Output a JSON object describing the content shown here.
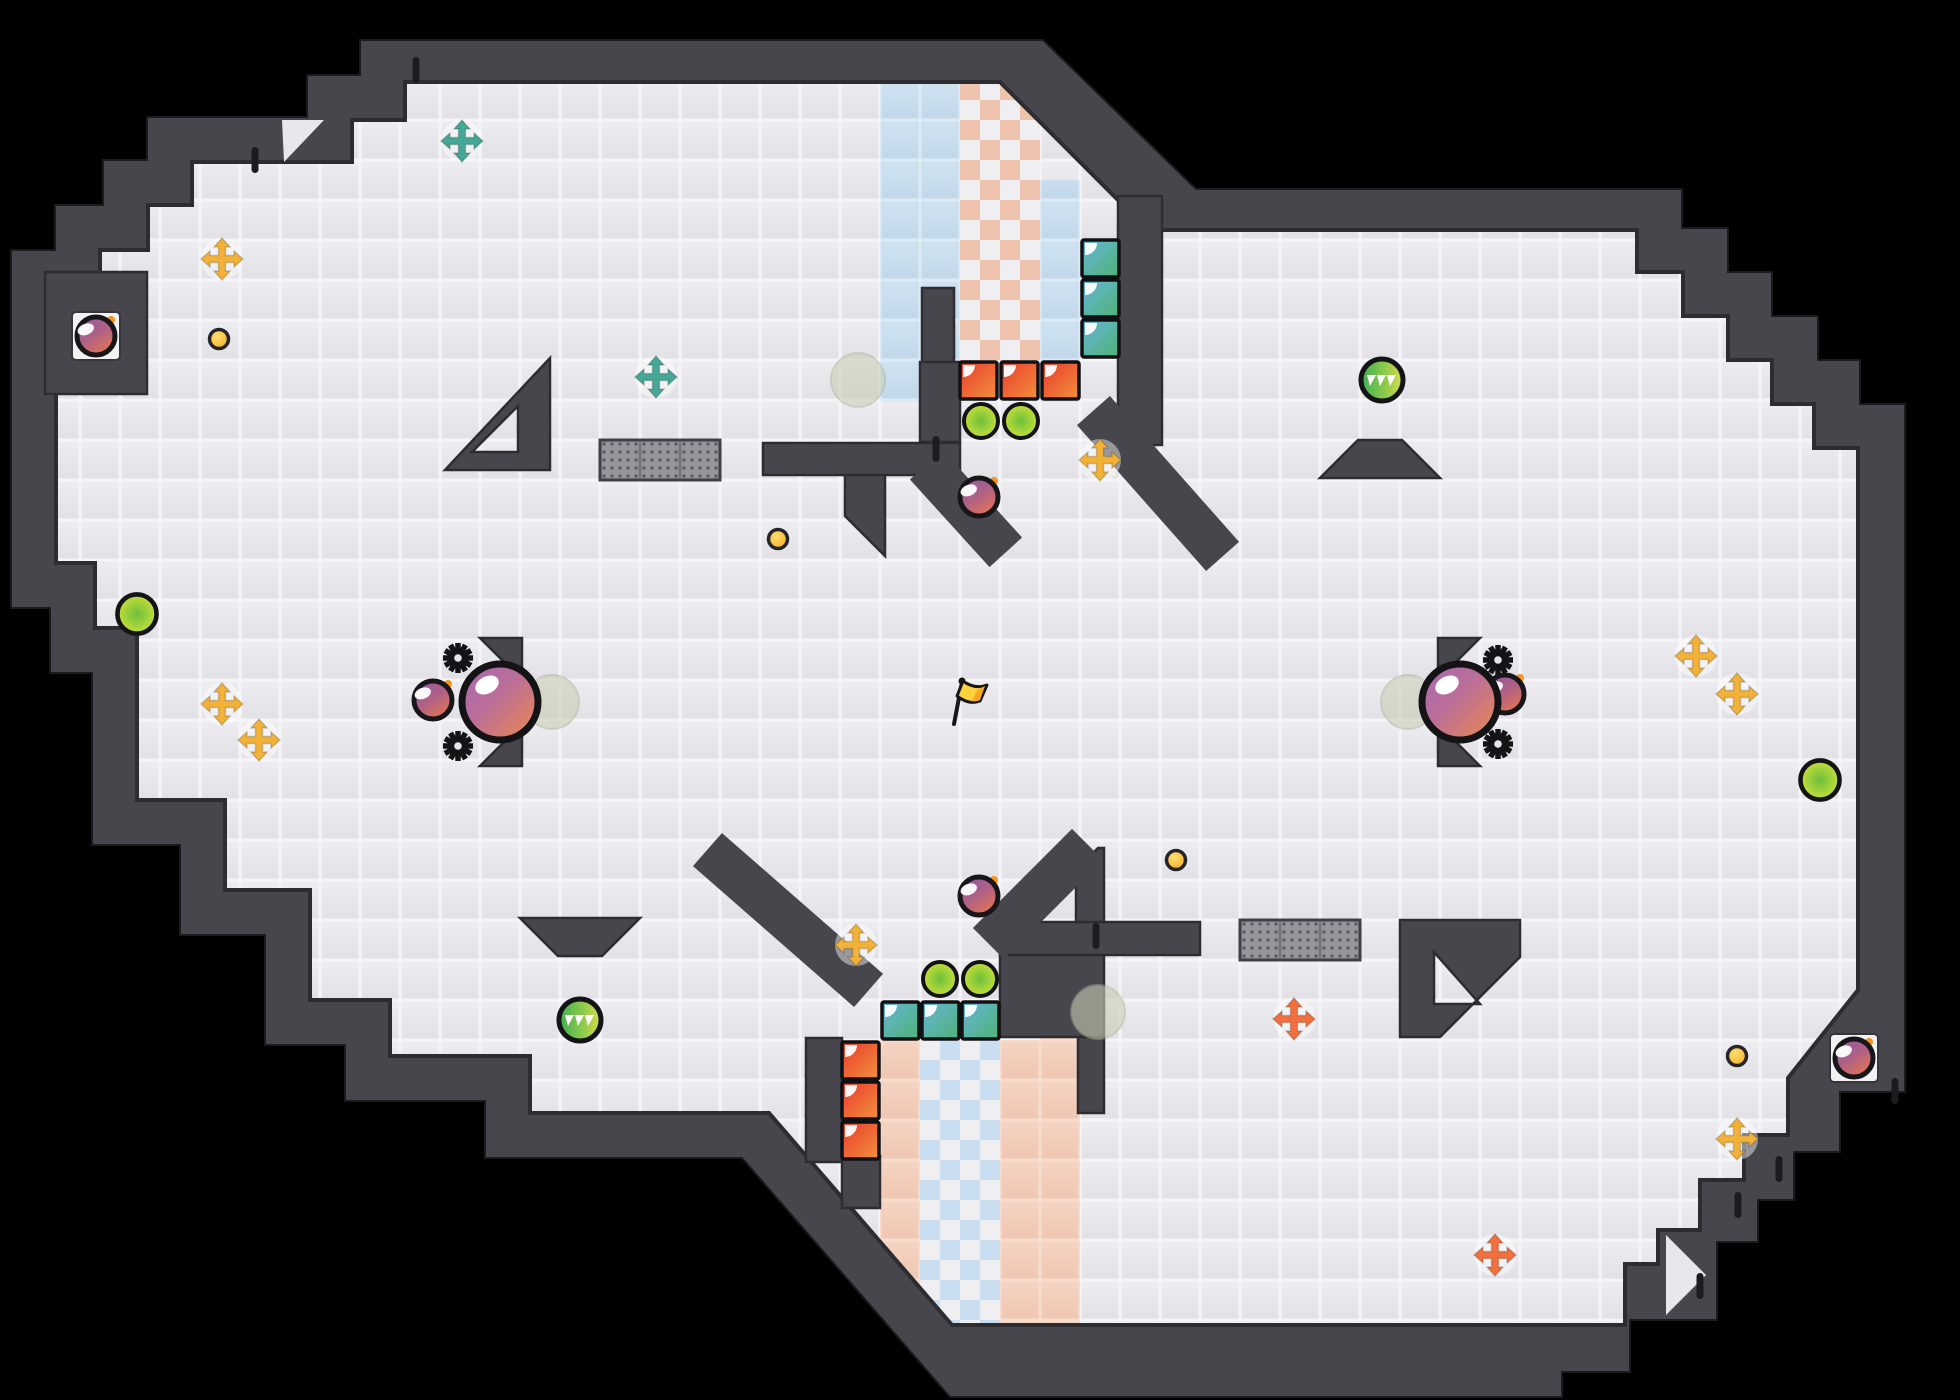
{
  "scene": {
    "kind": "top-down arena map",
    "width": 1960,
    "height": 1400,
    "background": "#000000"
  },
  "palette": {
    "wall": "#46464c",
    "wall_edge": "#2c2c31",
    "floor_grout": "#f5f4f7",
    "floor_tile": "#e8e7eb",
    "blue_tile": "#c7dcee",
    "peach_tile": "#f2cdba",
    "checker_peach": "#f0c3ae",
    "checker_blue": "#c9def0",
    "teal": "#45a795",
    "yellow": "#f2b239",
    "orange": "#f2703d",
    "coin": "#f7b62c",
    "flag": "#ffd23e",
    "ball_purple": "#a668b2",
    "ball_orange": "#ef8a4b",
    "block_teal_a": "#66b6da",
    "block_teal_b": "#4fb173",
    "block_red_a": "#ea3a2e",
    "block_red_b": "#f1913c",
    "pellet_green": "#6fbf3b",
    "pellet_yellow": "#e8e234",
    "spawn_marker": "#c9ceb4"
  },
  "items": [
    {
      "type": "spawn-marker",
      "name": "spawn-marker",
      "x": 858,
      "y": 380,
      "interactable": false
    },
    {
      "type": "spawn-marker",
      "name": "spawn-marker",
      "x": 552,
      "y": 702,
      "interactable": false
    },
    {
      "type": "spawn-marker",
      "name": "spawn-marker",
      "x": 1408,
      "y": 702,
      "interactable": false
    },
    {
      "type": "spawn-marker",
      "name": "spawn-marker",
      "x": 1098,
      "y": 1012,
      "interactable": false
    },
    {
      "type": "alcove",
      "name": "wall-alcove",
      "x": 72,
      "y": 312,
      "interactable": false
    },
    {
      "type": "alcove",
      "name": "wall-alcove",
      "x": 1830,
      "y": 1034,
      "interactable": false
    },
    {
      "type": "grate",
      "name": "grate-platform",
      "x": 600,
      "y": 440,
      "interactable": false
    },
    {
      "type": "grate",
      "name": "grate-platform",
      "x": 1240,
      "y": 920,
      "interactable": false
    },
    {
      "type": "teal-block",
      "name": "teal-block",
      "x": 1082,
      "y": 240,
      "interactable": true
    },
    {
      "type": "teal-block",
      "name": "teal-block",
      "x": 1082,
      "y": 280,
      "interactable": true
    },
    {
      "type": "teal-block",
      "name": "teal-block",
      "x": 1082,
      "y": 320,
      "interactable": true
    },
    {
      "type": "teal-block",
      "name": "teal-block",
      "x": 882,
      "y": 1002,
      "interactable": true
    },
    {
      "type": "teal-block",
      "name": "teal-block",
      "x": 922,
      "y": 1002,
      "interactable": true
    },
    {
      "type": "teal-block",
      "name": "teal-block",
      "x": 962,
      "y": 1002,
      "interactable": true
    },
    {
      "type": "red-block",
      "name": "red-block",
      "x": 960,
      "y": 362,
      "interactable": true
    },
    {
      "type": "red-block",
      "name": "red-block",
      "x": 1001,
      "y": 362,
      "interactable": true
    },
    {
      "type": "red-block",
      "name": "red-block",
      "x": 1042,
      "y": 362,
      "interactable": true
    },
    {
      "type": "red-block",
      "name": "red-block",
      "x": 842,
      "y": 1042,
      "interactable": true
    },
    {
      "type": "red-block",
      "name": "red-block",
      "x": 842,
      "y": 1082,
      "interactable": true
    },
    {
      "type": "red-block",
      "name": "red-block",
      "x": 842,
      "y": 1122,
      "interactable": true
    },
    {
      "type": "pellet",
      "name": "power-pellet",
      "x": 981,
      "y": 421,
      "interactable": true
    },
    {
      "type": "pellet",
      "name": "power-pellet",
      "x": 1021,
      "y": 421,
      "interactable": true
    },
    {
      "type": "pellet",
      "name": "power-pellet",
      "x": 940,
      "y": 979,
      "interactable": true
    },
    {
      "type": "pellet",
      "name": "power-pellet",
      "x": 980,
      "y": 979,
      "interactable": true
    },
    {
      "type": "pellet",
      "name": "power-pellet",
      "x": 137,
      "y": 614,
      "scale": 1.15,
      "interactable": true
    },
    {
      "type": "pellet",
      "name": "power-pellet",
      "x": 1820,
      "y": 780,
      "scale": 1.15,
      "interactable": true
    },
    {
      "type": "boost-cross",
      "name": "boost-cross-icon",
      "color": "teal",
      "x": 462,
      "y": 141,
      "interactable": true
    },
    {
      "type": "boost-cross",
      "name": "boost-cross-icon",
      "color": "teal",
      "x": 656,
      "y": 377,
      "interactable": true
    },
    {
      "type": "boost-cross",
      "name": "boost-cross-icon",
      "color": "yellow",
      "x": 222,
      "y": 259,
      "interactable": true
    },
    {
      "type": "boost-cross",
      "name": "boost-cross-icon",
      "color": "yellow",
      "x": 1100,
      "y": 460,
      "interactable": true
    },
    {
      "type": "boost-cross",
      "name": "boost-cross-icon",
      "color": "yellow",
      "x": 222,
      "y": 704,
      "interactable": true
    },
    {
      "type": "boost-cross",
      "name": "boost-cross-icon",
      "color": "yellow",
      "x": 259,
      "y": 740,
      "interactable": true
    },
    {
      "type": "boost-cross",
      "name": "boost-cross-icon",
      "color": "yellow",
      "x": 856,
      "y": 945,
      "interactable": true
    },
    {
      "type": "boost-cross",
      "name": "boost-cross-icon",
      "color": "yellow",
      "x": 1696,
      "y": 656,
      "interactable": true
    },
    {
      "type": "boost-cross",
      "name": "boost-cross-icon",
      "color": "yellow",
      "x": 1737,
      "y": 694,
      "interactable": true
    },
    {
      "type": "boost-cross",
      "name": "boost-cross-icon",
      "color": "yellow",
      "x": 1737,
      "y": 1139,
      "interactable": true
    },
    {
      "type": "boost-cross",
      "name": "boost-cross-icon",
      "color": "orange",
      "x": 1294,
      "y": 1019,
      "interactable": true
    },
    {
      "type": "boost-cross",
      "name": "boost-cross-icon",
      "color": "orange",
      "x": 1495,
      "y": 1255,
      "interactable": true
    },
    {
      "type": "coin",
      "name": "coin-dot",
      "x": 219,
      "y": 339,
      "interactable": true
    },
    {
      "type": "coin",
      "name": "coin-dot",
      "x": 778,
      "y": 539,
      "interactable": true
    },
    {
      "type": "coin",
      "name": "coin-dot",
      "x": 1176,
      "y": 860,
      "interactable": true
    },
    {
      "type": "coin",
      "name": "coin-dot",
      "x": 1737,
      "y": 1056,
      "interactable": true
    },
    {
      "type": "spike-ball",
      "name": "spike-ball",
      "x": 1382,
      "y": 380,
      "interactable": true
    },
    {
      "type": "spike-ball",
      "name": "spike-ball",
      "x": 580,
      "y": 1020,
      "interactable": true
    },
    {
      "type": "bomb",
      "name": "bomb",
      "x": 96,
      "y": 336,
      "interactable": true
    },
    {
      "type": "bomb",
      "name": "bomb",
      "x": 979,
      "y": 497,
      "interactable": true
    },
    {
      "type": "bomb",
      "name": "bomb",
      "x": 433,
      "y": 700,
      "interactable": true
    },
    {
      "type": "bomb",
      "name": "bomb",
      "x": 1505,
      "y": 694,
      "interactable": true
    },
    {
      "type": "bomb",
      "name": "bomb",
      "x": 979,
      "y": 896,
      "interactable": true
    },
    {
      "type": "bomb",
      "name": "bomb",
      "x": 1854,
      "y": 1058,
      "interactable": true
    },
    {
      "type": "gear",
      "name": "gear-icon",
      "x": 458,
      "y": 658,
      "interactable": false
    },
    {
      "type": "gear",
      "name": "gear-icon",
      "x": 458,
      "y": 746,
      "interactable": false
    },
    {
      "type": "gear",
      "name": "gear-icon",
      "x": 1498,
      "y": 660,
      "interactable": false
    },
    {
      "type": "gear",
      "name": "gear-icon",
      "x": 1498,
      "y": 744,
      "interactable": false
    },
    {
      "type": "player-ball",
      "name": "player-ball",
      "x": 500,
      "y": 702,
      "interactable": true
    },
    {
      "type": "player-ball",
      "name": "player-ball",
      "x": 1460,
      "y": 702,
      "interactable": true
    },
    {
      "type": "flag",
      "name": "flag",
      "x": 958,
      "y": 698,
      "interactable": true
    },
    {
      "type": "tick",
      "name": "wall-notch",
      "x": 416,
      "y": 70,
      "interactable": false
    },
    {
      "type": "tick",
      "name": "wall-notch",
      "x": 255,
      "y": 160,
      "interactable": false
    },
    {
      "type": "tick",
      "name": "wall-notch",
      "x": 936,
      "y": 449,
      "interactable": false
    },
    {
      "type": "tick",
      "name": "wall-notch",
      "x": 1096,
      "y": 936,
      "interactable": false
    },
    {
      "type": "tick",
      "name": "wall-notch",
      "x": 1779,
      "y": 1169,
      "interactable": false
    },
    {
      "type": "tick",
      "name": "wall-notch",
      "x": 1738,
      "y": 1205,
      "interactable": false
    },
    {
      "type": "tick",
      "name": "wall-notch",
      "x": 1700,
      "y": 1286,
      "interactable": false
    },
    {
      "type": "tick",
      "name": "wall-notch",
      "x": 1895,
      "y": 1091,
      "interactable": false
    }
  ]
}
